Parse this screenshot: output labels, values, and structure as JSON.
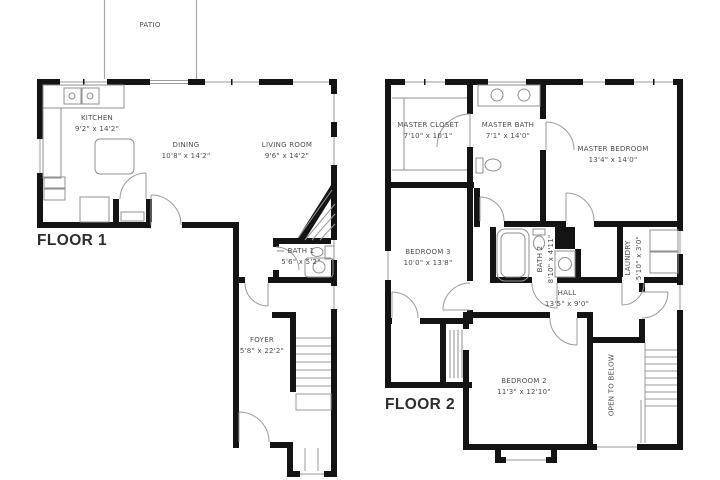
{
  "colors": {
    "wall": "#141414",
    "thin_line": "#9a9a9a",
    "text": "#4c4c4c",
    "title": "#2d2d2d",
    "background": "#ffffff"
  },
  "floor1": {
    "title": "FLOOR 1",
    "patio": {
      "name": "PATIO"
    },
    "kitchen": {
      "name": "KITCHEN",
      "dims": "9'2\" x 14'2\""
    },
    "dining": {
      "name": "DINING",
      "dims": "10'8\" x 14'2\""
    },
    "living_room": {
      "name": "LIVING ROOM",
      "dims": "9'6\" x 14'2\""
    },
    "bath1": {
      "name": "BATH 1",
      "dims": "5'6\" x 5'2\""
    },
    "foyer": {
      "name": "FOYER",
      "dims": "5'8\" x 22'2\""
    }
  },
  "floor2": {
    "title": "FLOOR 2",
    "master_closet": {
      "name": "MASTER CLOSET",
      "dims": "7'10\" x 10'1\""
    },
    "master_bath": {
      "name": "MASTER BATH",
      "dims": "7'1\" x 14'0\""
    },
    "master_bedroom": {
      "name": "MASTER BEDROOM",
      "dims": "13'4\" x 14'0\""
    },
    "bedroom3": {
      "name": "BEDROOM 3",
      "dims": "10'0\" x 13'8\""
    },
    "bath2": {
      "name": "BATH 2",
      "dims": "8'10\" x 4'11\""
    },
    "laundry": {
      "name": "LAUNDRY",
      "dims": "5'10\" x 3'0\""
    },
    "hall": {
      "name": "HALL",
      "dims": "13'5\" x 9'0\""
    },
    "bedroom2": {
      "name": "BEDROOM 2",
      "dims": "11'3\" x 12'10\""
    },
    "open_to_below": {
      "name": "OPEN TO BELOW"
    }
  }
}
